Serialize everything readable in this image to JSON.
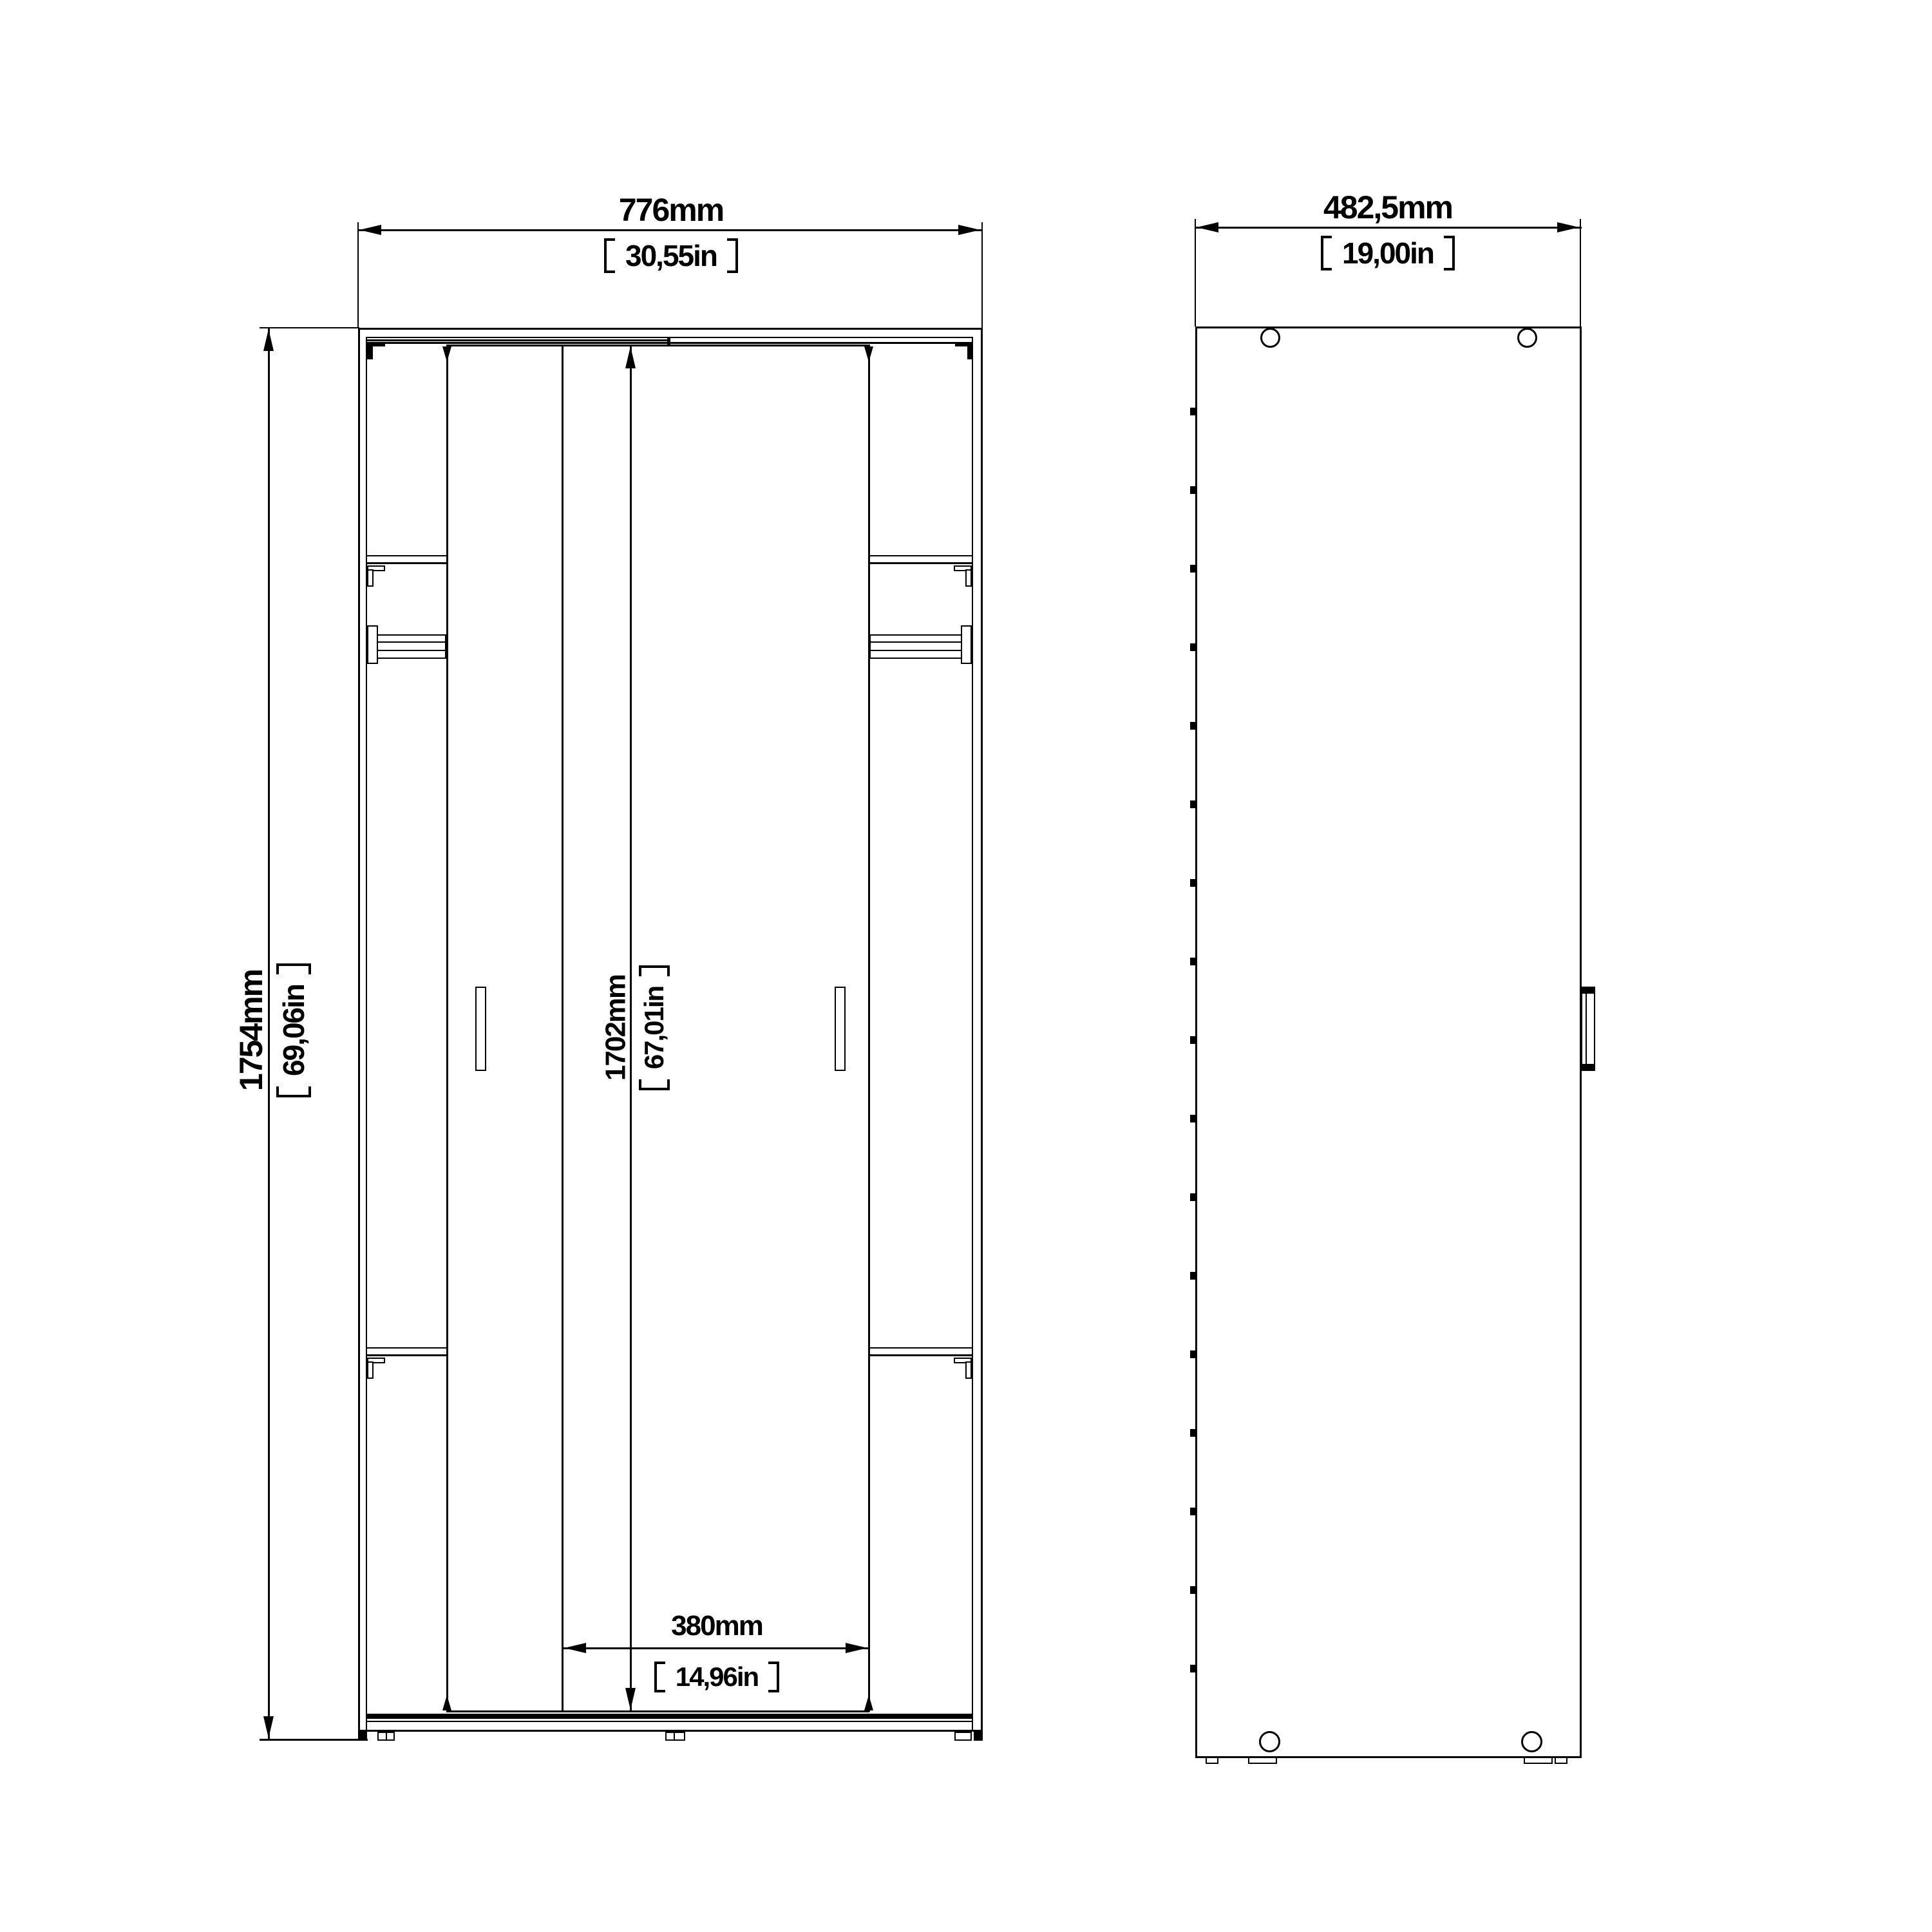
{
  "front_view": {
    "width_mm": "776mm",
    "width_in": "30,55in",
    "height_mm": "1754mm",
    "height_in": "69,06in",
    "interior_height_mm": "1702mm",
    "interior_height_in": "67,01in",
    "door_width_mm": "380mm",
    "door_width_in": "14,96in"
  },
  "side_view": {
    "depth_mm": "482,5mm",
    "depth_in": "19,00in"
  },
  "colors": {
    "line": "#000000",
    "background": "#ffffff"
  }
}
